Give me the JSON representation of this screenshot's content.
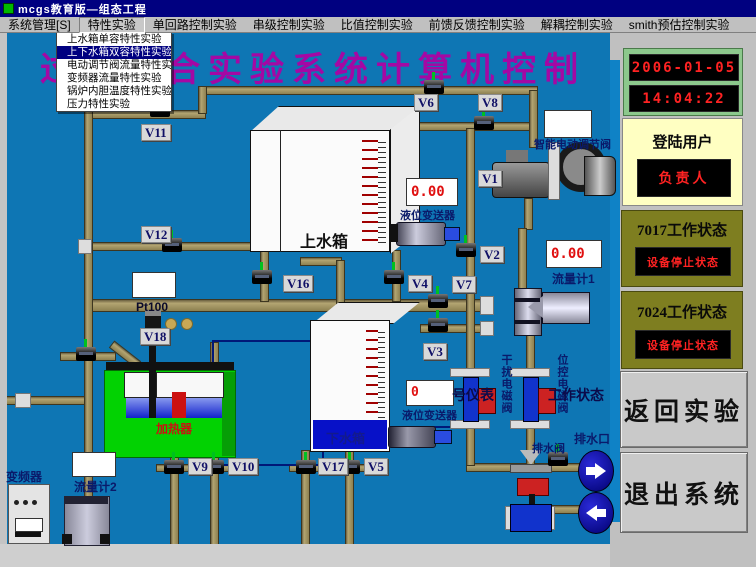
{
  "window": {
    "title": "mcgs教育版—组态工程"
  },
  "menubar": {
    "items": [
      "系统管理[S]",
      "特性实验",
      "单回路控制实验",
      "串级控制实验",
      "比值控制实验",
      "前馈反馈控制实验",
      "解耦控制实验",
      "smith预估控制实验"
    ],
    "pressed": "特性实验"
  },
  "dropdown": {
    "items": [
      "上水箱单容特性实验",
      "上下水箱双容特性实验",
      "电动调节阀流量特性实验",
      "变频器流量特性实验",
      "锅炉内胆温度特性实验",
      "压力特性实验"
    ],
    "selected": "上下水箱双容特性实验"
  },
  "main_title": {
    "text": "过程综合实验系统计算机控制"
  },
  "diagram": {
    "valves": [
      "V11",
      "V12",
      "V18",
      "V6",
      "V8",
      "V16",
      "V4",
      "V7",
      "V3",
      "V1",
      "V2",
      "V9",
      "V10",
      "V17",
      "V5"
    ],
    "labels": {
      "upper_tank": "上水箱",
      "lower_tank": "下水箱",
      "heater": "加热器",
      "pt100": "Pt100",
      "inverter": "变频器",
      "flow_meter_1": "流量计1",
      "flow_meter_2": "流量计2",
      "level_transmitter_upper": "液位变送器",
      "level_transmitter_lower": "液位变送器",
      "smart_valve": "智能电动调节阀",
      "drain_valve": "排水阀",
      "drain_outlet": "排水口",
      "interference_solenoid": "干扰电磁阀",
      "position_solenoid": "位控电磁阀",
      "overlay_left": "号仪表",
      "overlay_right": "工作状态"
    },
    "displays": {
      "upper_level": "0.00",
      "flow1": "0.00",
      "lower_level": "0",
      "pt100": "",
      "flow2": "",
      "smart_valve": ""
    }
  },
  "sidebar": {
    "date": "2006-01-05",
    "time": "14:04:22",
    "login_label": "登陆用户",
    "login_user": "负责人",
    "status_7017_title": "7017工作状态",
    "status_7017_value": "设备停止状态",
    "status_7024_title": "7024工作状态",
    "status_7024_value": "设备停止状态",
    "return_button": "返回实验",
    "exit_button": "退出系统"
  },
  "colors": {
    "canvas_background": "#0e76b4",
    "main_title": "#a408a4",
    "lcd_text": "#ff2222",
    "pipe": "#a89a66",
    "status_panel": "#7e7e20",
    "login_panel": "#ffffc2",
    "heater_tank": "#02d202"
  }
}
